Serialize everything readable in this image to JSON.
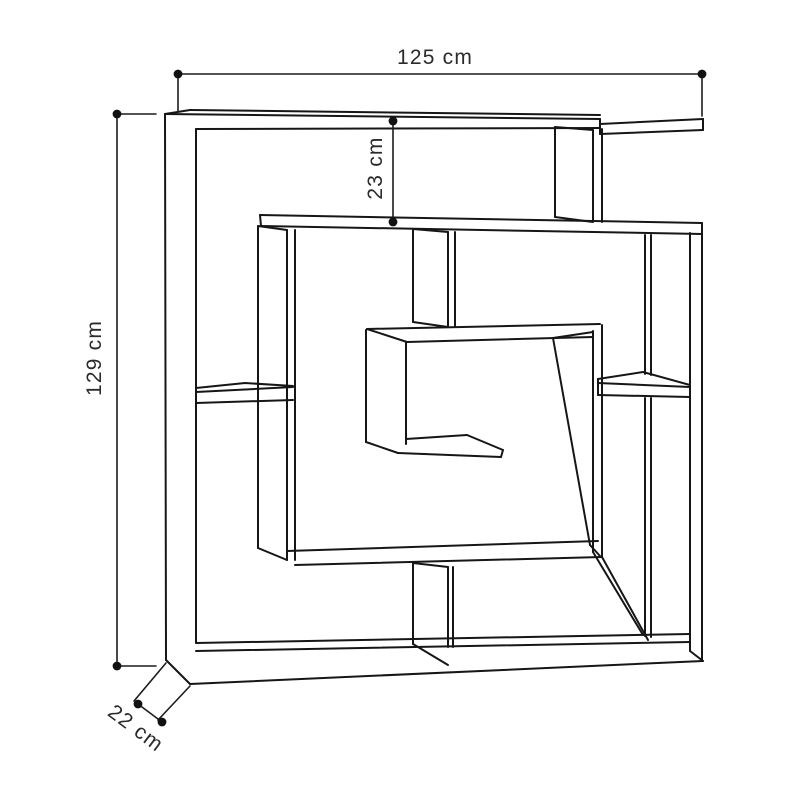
{
  "diagram": {
    "type": "furniture dimension line drawing",
    "subject": "maze / labyrinth style open bookshelf",
    "background_color": "#ffffff",
    "line_color": "#161616",
    "text_color": "#2b2b2b",
    "dimensions": {
      "width_label": "125 cm",
      "height_label": "129 cm",
      "top_section_label": "23 cm",
      "depth_label": "22 cm"
    }
  }
}
